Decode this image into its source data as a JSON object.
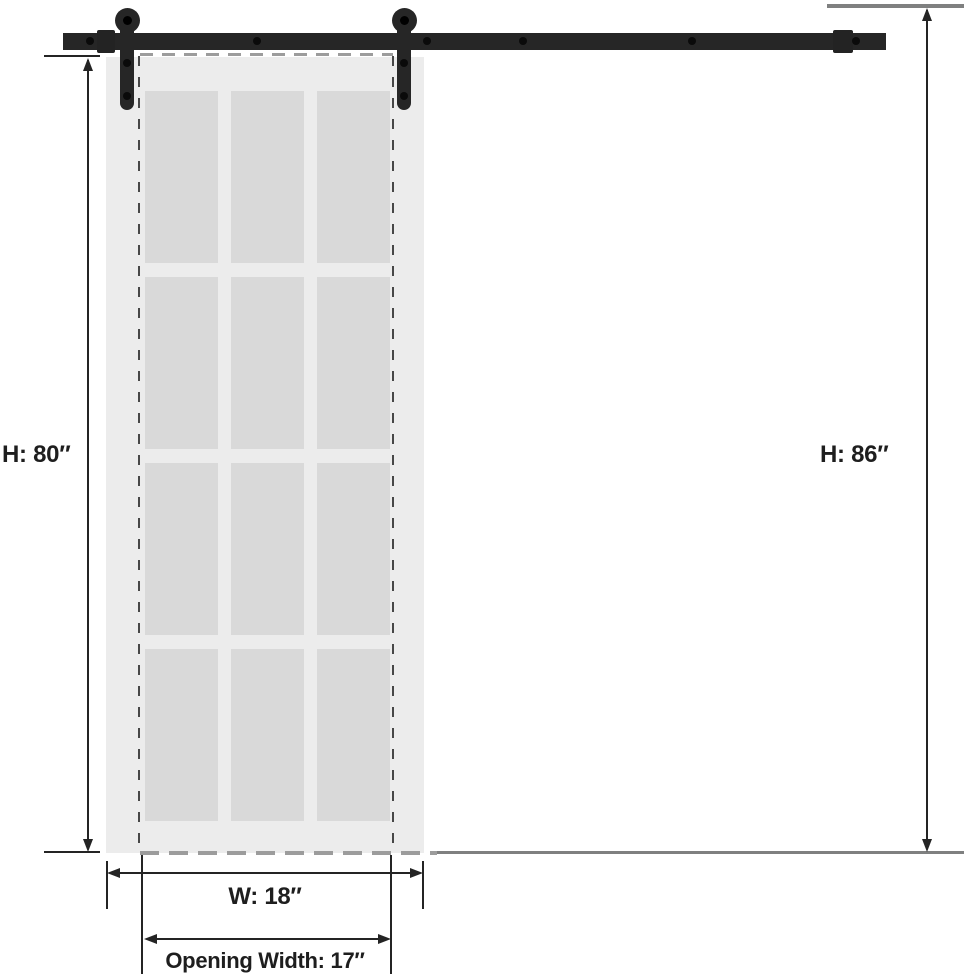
{
  "page": {
    "type": "product-dimension-diagram",
    "subject": "sliding barn door with 12-lite frosted glass panel and top-mount black rail hardware",
    "background": "#ffffff"
  },
  "labels": {
    "door_height": "H: 80″",
    "overall_height": "H: 86″",
    "door_width": "W: 18″",
    "opening_width": "Opening Width: 17″"
  },
  "dimensions": {
    "door_height_in": 80,
    "overall_height_in": 86,
    "door_width_in": 18,
    "opening_width_in": 17,
    "unit": "inch"
  },
  "door": {
    "glass_columns": 3,
    "glass_rows": 4,
    "glass_panes": 12
  },
  "hardware": {
    "rollers": 2,
    "rail_bolts": 6,
    "end_brackets": 2
  },
  "colors": {
    "hardware": "#262626",
    "door_body": "#ececec",
    "glass_pane": "#d9d9d9",
    "reference_line": "#7f8080",
    "opening_dash_gray": "#9c9c9c",
    "opening_dash_dark": "#474747",
    "dimension_ink": "#1e1e1e"
  }
}
